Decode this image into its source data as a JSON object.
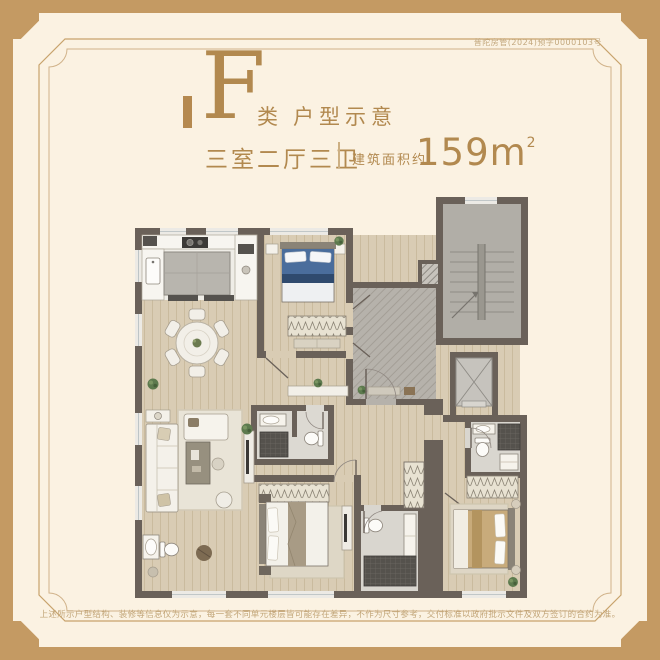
{
  "frame": {
    "permit_no": "普陀房管(2024)预字0000103号"
  },
  "header": {
    "type_letter": "F",
    "type_suffix": "类",
    "type_subtitle": "户型示意",
    "layout": "三室二厅三卫",
    "area_label": "建筑面积约",
    "area_value": "159",
    "area_unit": "m",
    "area_exponent": "2"
  },
  "footer": {
    "disclaimer": "上述所示户型结构、装修等信息仅为示意，每一套不同单元楼层皆可能存在差异，不作为尺寸参考，交付标准以政府批示文件及双方签订的合约为准。"
  },
  "colors": {
    "background": "#fbf2e2",
    "frame_gold": "#c49a63",
    "accent_gold": "#b2894f",
    "text_tan": "#c2a578",
    "wall": "#6a6159",
    "wood_floor": "#d9ccb4",
    "foyer_gray": "#b6b2ab",
    "stair_gray": "#b1aea7",
    "bed_blue": "#4a6d9c",
    "bed_tan": "#c8ab7b"
  }
}
